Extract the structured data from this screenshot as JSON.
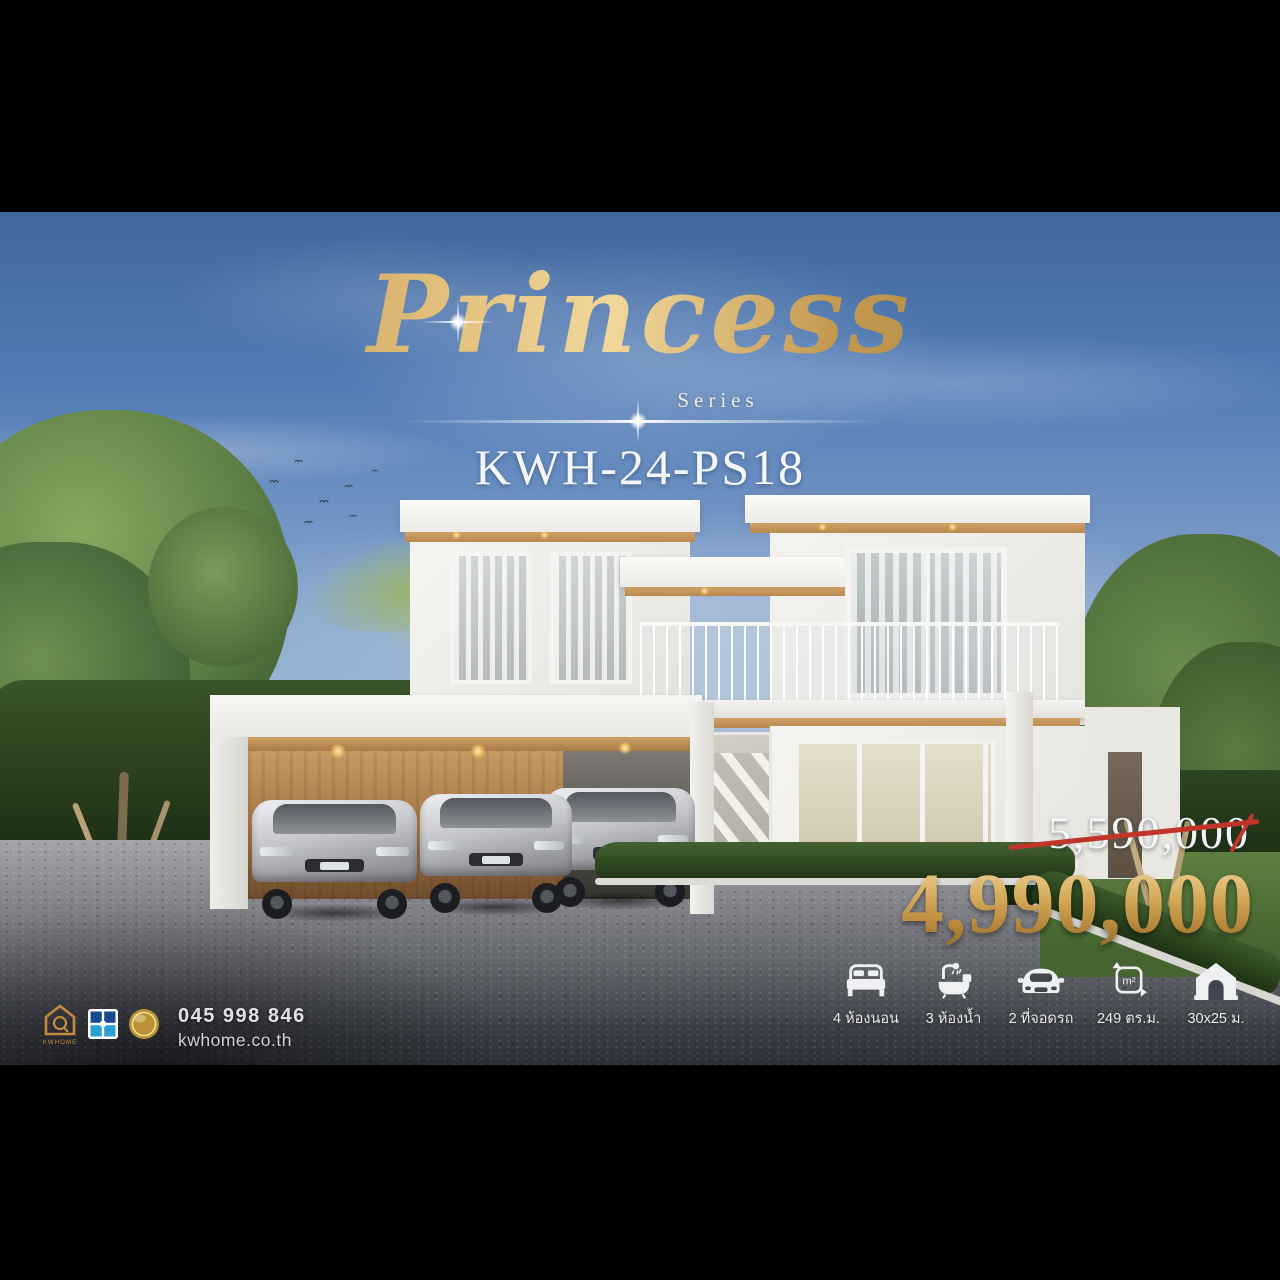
{
  "branding": {
    "title": "Princess",
    "subtitle": "Series",
    "model_code": "KWH-24-PS18",
    "logo_text": "KWHOME"
  },
  "pricing": {
    "original_price": "5,590,000",
    "sale_price": "4,990,000"
  },
  "specs": [
    {
      "icon": "bed-icon",
      "label": "4 ห้องนอน"
    },
    {
      "icon": "bath-icon",
      "label": "3 ห้องน้ำ"
    },
    {
      "icon": "car-icon",
      "label": "2 ที่จอดรถ"
    },
    {
      "icon": "area-icon",
      "label": "249 ตร.ม.",
      "unit_symbol": "m²"
    },
    {
      "icon": "house-icon",
      "label": "30x25 ม."
    }
  ],
  "contact": {
    "phone": "045 998 846",
    "website": "kwhome.co.th"
  },
  "colors": {
    "title_gold": "#d8b36a",
    "price_gold": "#c79c4e",
    "strike_red": "#c0352a",
    "sky_top": "#41689e",
    "wood_accent": "#c39357"
  }
}
